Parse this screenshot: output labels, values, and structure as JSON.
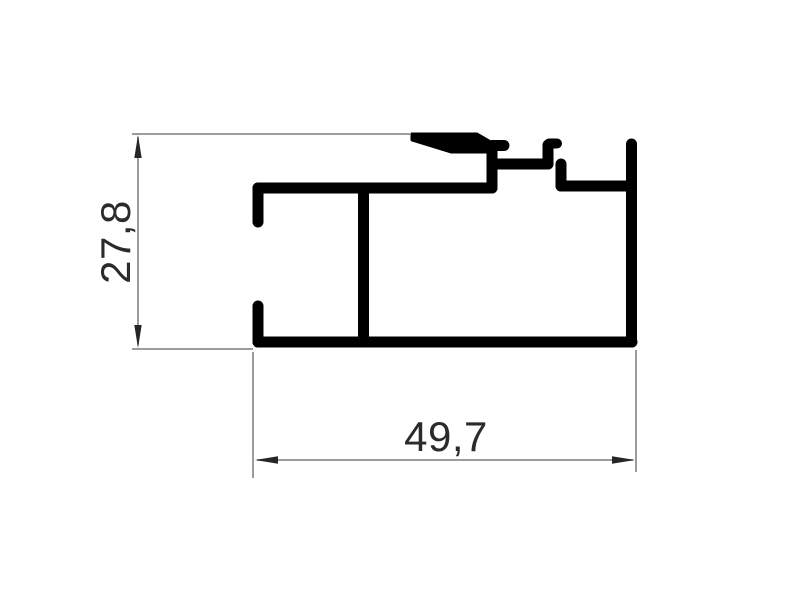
{
  "drawing": {
    "type": "aluminum-extrusion-profile-cross-section",
    "background_color": "#ffffff",
    "profile_color": "#000000",
    "dimension_line_color": "#7b7b7b",
    "arrow_color": "#262626",
    "text_color": "#2b2b2b",
    "dimensions": {
      "height": {
        "label": "27,8",
        "orientation": "vertical",
        "units": "mm"
      },
      "width": {
        "label": "49,7",
        "orientation": "horizontal",
        "units": "mm"
      }
    }
  }
}
